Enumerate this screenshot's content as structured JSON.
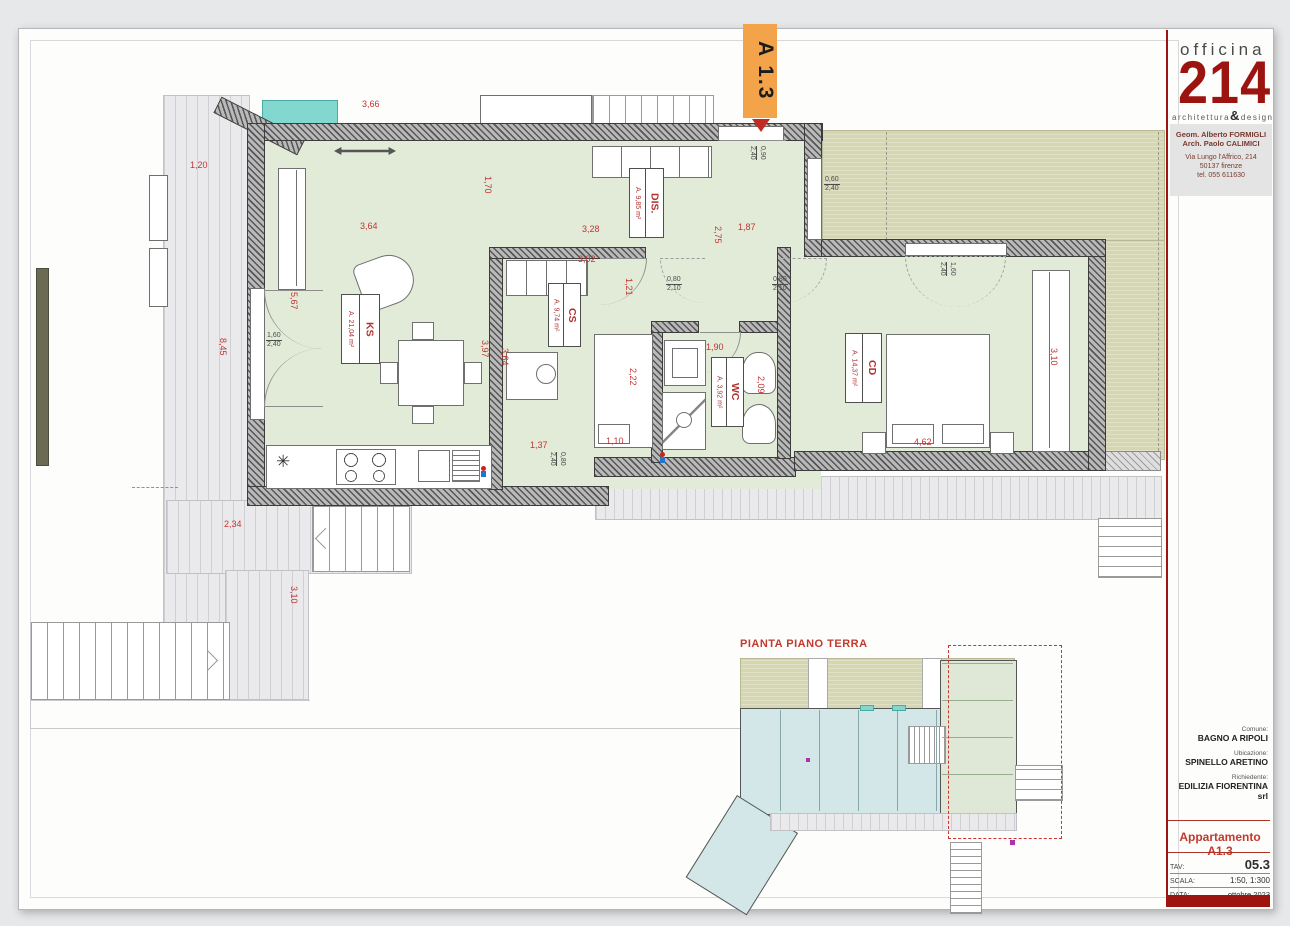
{
  "colors": {
    "accent_red": "#9e150f",
    "dim_red": "#c23434",
    "label_red": "#b23230",
    "tag_orange": "#f3a44a",
    "teal_window": "#82d7cf",
    "floor_green": "#e2ead8",
    "garden_olive": "#d5d7b3"
  },
  "title_block": {
    "studio_name": "officina",
    "studio_number": "214",
    "tagline_left": "architettura",
    "tagline_amp": "&",
    "tagline_right": "design",
    "architects": [
      "Geom. Alberto FORMIGLI",
      "Arch. Paolo CALIMICI"
    ],
    "address": [
      "Via Lungo l'Affrico, 214",
      "50137 firenze",
      "tel. 055 611630"
    ],
    "comune_label": "Comune:",
    "comune": "BAGNO A RIPOLI",
    "ubicazione_label": "Ubicazione:",
    "ubicazione": "SPINELLO ARETINO",
    "richiedente_label": "Richiedente:",
    "richiedente": "EDILIZIA FIORENTINA srl",
    "apartment_title": "Appartamento A1.3",
    "rows": [
      {
        "label": "TAV:",
        "value": "05.3"
      },
      {
        "label": "SCALA:",
        "value": "1:50, 1:300"
      },
      {
        "label": "DATA:",
        "value": "ottobre 2023"
      }
    ]
  },
  "plan": {
    "apartment_tag": "A 1.3",
    "rooms": [
      {
        "name": "KS",
        "area": "A. 21,04 m²"
      },
      {
        "name": "CS",
        "area": "A. 9,74 m²"
      },
      {
        "name": "DIS.",
        "area": "A. 9,85 m²"
      },
      {
        "name": "WC",
        "area": "A. 3,92 m²"
      },
      {
        "name": "CD",
        "area": "A. 14,37 m²"
      }
    ],
    "dimensions": [
      {
        "v": "3,66"
      },
      {
        "v": "1,20"
      },
      {
        "v": "1,70"
      },
      {
        "v": "3,64"
      },
      {
        "v": "3,28"
      },
      {
        "v": "1,87"
      },
      {
        "v": "2,75"
      },
      {
        "v": "3,02"
      },
      {
        "v": "1,21"
      },
      {
        "v": "5,67"
      },
      {
        "v": "8,45"
      },
      {
        "v": "3,97"
      },
      {
        "v": "3,64"
      },
      {
        "v": "2,22"
      },
      {
        "v": "1,10"
      },
      {
        "v": "1,37"
      },
      {
        "v": "1,90"
      },
      {
        "v": "2,09"
      },
      {
        "v": "4,62"
      },
      {
        "v": "3,10"
      },
      {
        "v": "2,34"
      },
      {
        "v": "3,10"
      }
    ],
    "openings": [
      {
        "w": "1,60",
        "h": "2,40"
      },
      {
        "w": "0,80",
        "h": "2,10"
      },
      {
        "w": "0,80",
        "h": "2,10"
      },
      {
        "w": "0,60",
        "h": "2,40"
      },
      {
        "w": "1,60",
        "h": "2,40"
      },
      {
        "w": "0,80",
        "h": "2,40"
      },
      {
        "w": "0,90",
        "h": "2,40"
      }
    ],
    "icons": {
      "freezer": "✳"
    }
  },
  "overview": {
    "title": "PIANTA PIANO TERRA"
  }
}
